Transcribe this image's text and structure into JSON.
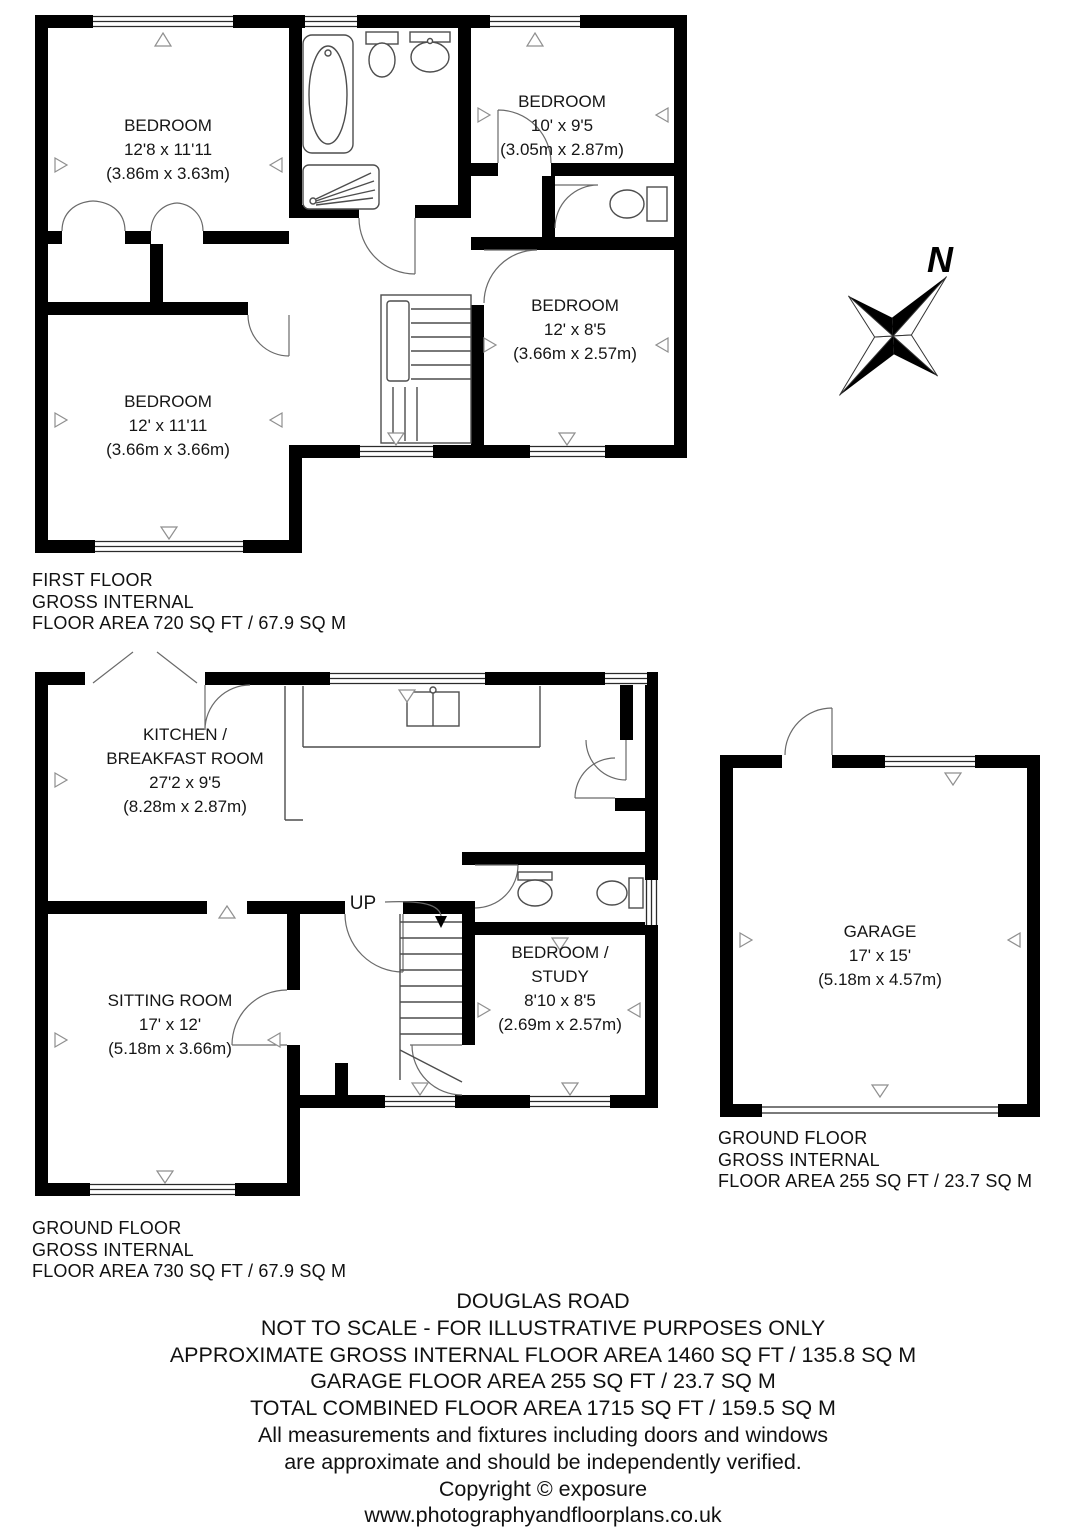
{
  "first_floor": {
    "rooms": [
      {
        "lines": [
          "BEDROOM",
          "12'8 x 11'11",
          "(3.86m x 3.63m)"
        ]
      },
      {
        "lines": [
          "BEDROOM",
          "10' x 9'5",
          "(3.05m x 2.87m)"
        ]
      },
      {
        "lines": [
          "BEDROOM",
          "12' x 8'5",
          "(3.66m x 2.57m)"
        ]
      },
      {
        "lines": [
          "BEDROOM",
          "12' x 11'11",
          "(3.66m x 3.66m)"
        ]
      }
    ],
    "label_lines": [
      "FIRST FLOOR",
      "GROSS INTERNAL",
      "FLOOR AREA 720 SQ FT / 67.9 SQ M"
    ]
  },
  "ground_floor": {
    "rooms": [
      {
        "lines": [
          "KITCHEN /",
          "BREAKFAST ROOM",
          "27'2 x 9'5",
          "(8.28m x 2.87m)"
        ]
      },
      {
        "lines": [
          "SITTING ROOM",
          "17' x 12'",
          "(5.18m x 3.66m)"
        ]
      },
      {
        "lines": [
          "BEDROOM /",
          "STUDY",
          "8'10 x 8'5",
          "(2.69m x 2.57m)"
        ]
      }
    ],
    "stairs_label": "UP",
    "label_lines": [
      "GROUND FLOOR",
      "GROSS INTERNAL",
      "FLOOR AREA 730 SQ FT / 67.9 SQ M"
    ]
  },
  "garage": {
    "room": {
      "lines": [
        "GARAGE",
        "17' x 15'",
        "(5.18m x 4.57m)"
      ]
    },
    "label_lines": [
      "GROUND FLOOR",
      "GROSS INTERNAL",
      "FLOOR AREA 255 SQ FT / 23.7 SQ M"
    ]
  },
  "compass": {
    "label": "N"
  },
  "footer": {
    "lines": [
      "DOUGLAS ROAD",
      "NOT TO SCALE - FOR ILLUSTRATIVE PURPOSES ONLY",
      "APPROXIMATE GROSS INTERNAL FLOOR AREA 1460 SQ FT / 135.8 SQ M",
      "GARAGE FLOOR AREA 255 SQ FT / 23.7 SQ M",
      "TOTAL COMBINED FLOOR AREA 1715 SQ FT / 159.5 SQ M",
      "All measurements and fixtures including doors and windows",
      "are approximate and should be independently verified.",
      "Copyright © exposure",
      "www.photographyandfloorplans.co.uk"
    ]
  },
  "colors": {
    "wall": "#000000",
    "detail_line": "#4d4d4d",
    "text": "#111111",
    "background": "#ffffff"
  }
}
